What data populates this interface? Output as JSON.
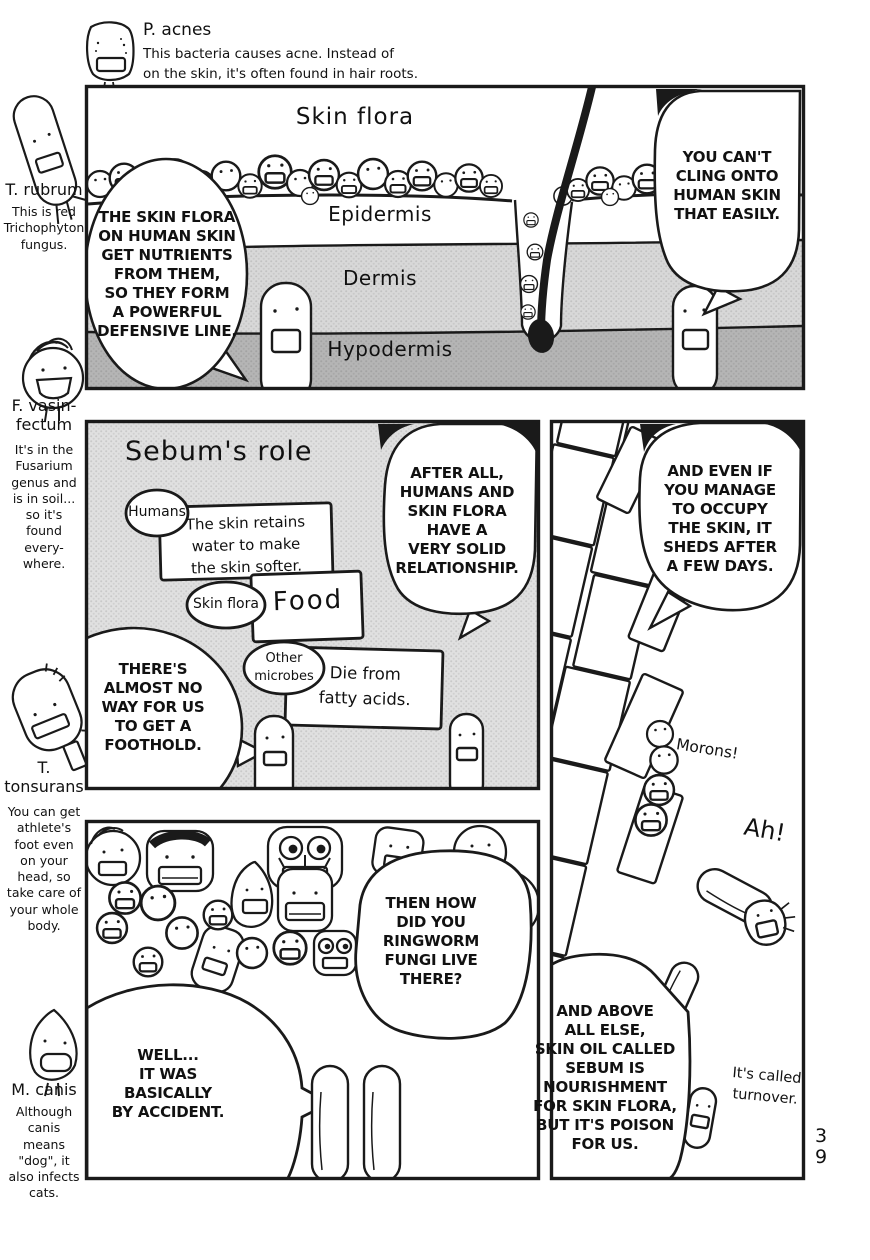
{
  "page": {
    "number_vertical": "3\n9",
    "ink": "#1a1a1a",
    "halftone": "#e0e0e0"
  },
  "header": {
    "name": "P. acnes",
    "description": "This bacteria causes acne. Instead of\non the skin, it's often found in hair roots."
  },
  "margin_notes": [
    {
      "name": "T. rubrum",
      "description": "This is red\nTrichophyton\nfungus."
    },
    {
      "name": "F. vasin-\nfectum",
      "description": "It's in the\nFusarium\ngenus and\nis in soil...\nso it's\nfound\nevery-\nwhere."
    },
    {
      "name": "T.\ntonsurans",
      "description": "You can get\nathlete's\nfoot even\non your\nhead, so\ntake care of\nyour whole\nbody."
    },
    {
      "name": "M. canis",
      "description": "Although\ncanis\nmeans\n\"dog\", it\nalso infects\ncats."
    }
  ],
  "panel_skin": {
    "title": "Skin flora",
    "layer_epidermis": "Epidermis",
    "layer_dermis": "Dermis",
    "layer_hypodermis": "Hypodermis",
    "bubble_left": "THE SKIN FLORA\nON HUMAN SKIN\nGET NUTRIENTS\nFROM THEM,\nSO THEY FORM\nA POWERFUL\nDEFENSIVE LINE.",
    "bubble_right": "YOU CAN'T\nCLING ONTO\nHUMAN SKIN\nTHAT EASILY."
  },
  "panel_sebum": {
    "title": "Sebum's role",
    "node_humans": "Humans",
    "note_skin_softer": "The skin retains\nwater to make\nthe skin softer.",
    "node_skin_flora": "Skin flora",
    "note_food": "Food",
    "node_other_microbes": "Other\nmicrobes",
    "note_fatty_acids": "Die from\nfatty acids.",
    "bubble_right": "AFTER ALL,\nHUMANS AND\nSKIN FLORA\nHAVE A\nVERY SOLID\nRELATIONSHIP.",
    "bubble_left": "THERE'S\nALMOST NO\nWAY FOR US\nTO GET A\nFOOTHOLD."
  },
  "panel_turnover": {
    "bubble_top": "AND EVEN IF\nYOU MANAGE\nTO OCCUPY\nTHE SKIN, IT\nSHEDS AFTER\nA FEW DAYS.",
    "shout_morons": "Morons!",
    "shout_ah": "Ah!",
    "bubble_bottom": "AND ABOVE\nALL ELSE,\nSKIN OIL CALLED\nSEBUM IS\nNOURISHMENT\nFOR SKIN FLORA,\nBUT IT'S POISON\nFOR US.",
    "caption_turnover": "It's called\nturnover."
  },
  "panel_crowd": {
    "bubble_question": "THEN HOW\nDID YOU\nRINGWORM\nFUNGI LIVE\nTHERE?",
    "bubble_answer": "WELL...\nIT WAS\nBASICALLY\nBY ACCIDENT."
  }
}
